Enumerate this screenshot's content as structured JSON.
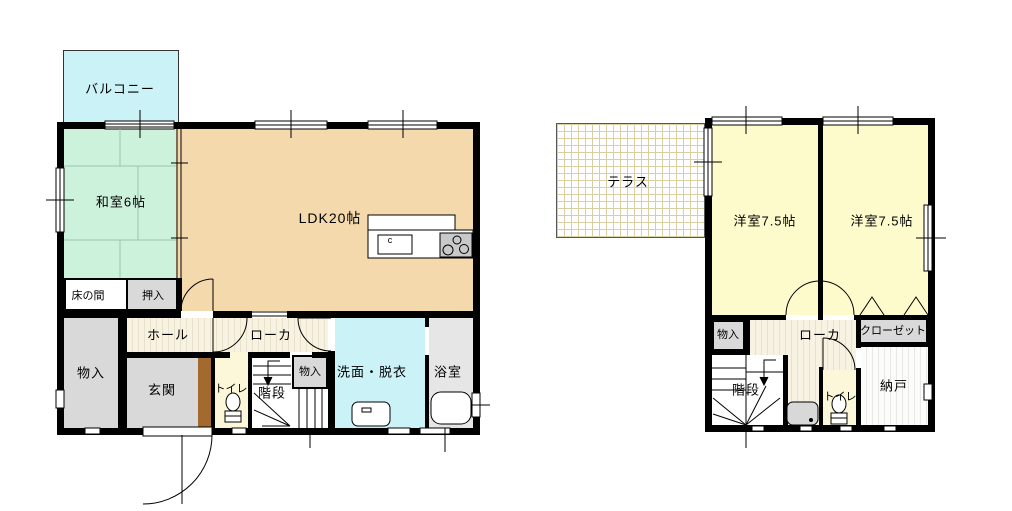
{
  "first_floor": {
    "balcony": "バルコニー",
    "japanese_room": "和室6帖",
    "ldk": "LDK20帖",
    "tokonoma": "床の間",
    "oshiire": "押入",
    "hall": "ホール",
    "corridor": "ローカ",
    "storage_left": "物入",
    "entrance": "玄関",
    "toilet": "トイレ",
    "stairs": "階段",
    "storage_stairs": "物入",
    "washroom": "洗面・脱衣",
    "bathroom": "浴室",
    "sink_mark": "c"
  },
  "second_floor": {
    "terrace": "テラス",
    "bedroom1": "洋室7.5帖",
    "bedroom2": "洋室7.5帖",
    "storage": "物入",
    "corridor": "ローカ",
    "closet": "クローゼット",
    "stairs": "階段",
    "toilet": "トイレ",
    "storage_room": "納戸"
  },
  "colors": {
    "wall": "#000000",
    "tatami_room": "#CDF2DC",
    "ldk": "#F4D9AC",
    "balcony": "#CBF2F7",
    "washroom": "#CBF2F7",
    "western_room": "#FDFACC",
    "toilet": "#FBF7D8",
    "storage_gray": "#D9D9D9",
    "bathroom": "#E6E6E6",
    "entrance_step": "#A26A2E",
    "wood_floor": "#F7F2E2",
    "terrace_grid": "#D9CEA4"
  }
}
